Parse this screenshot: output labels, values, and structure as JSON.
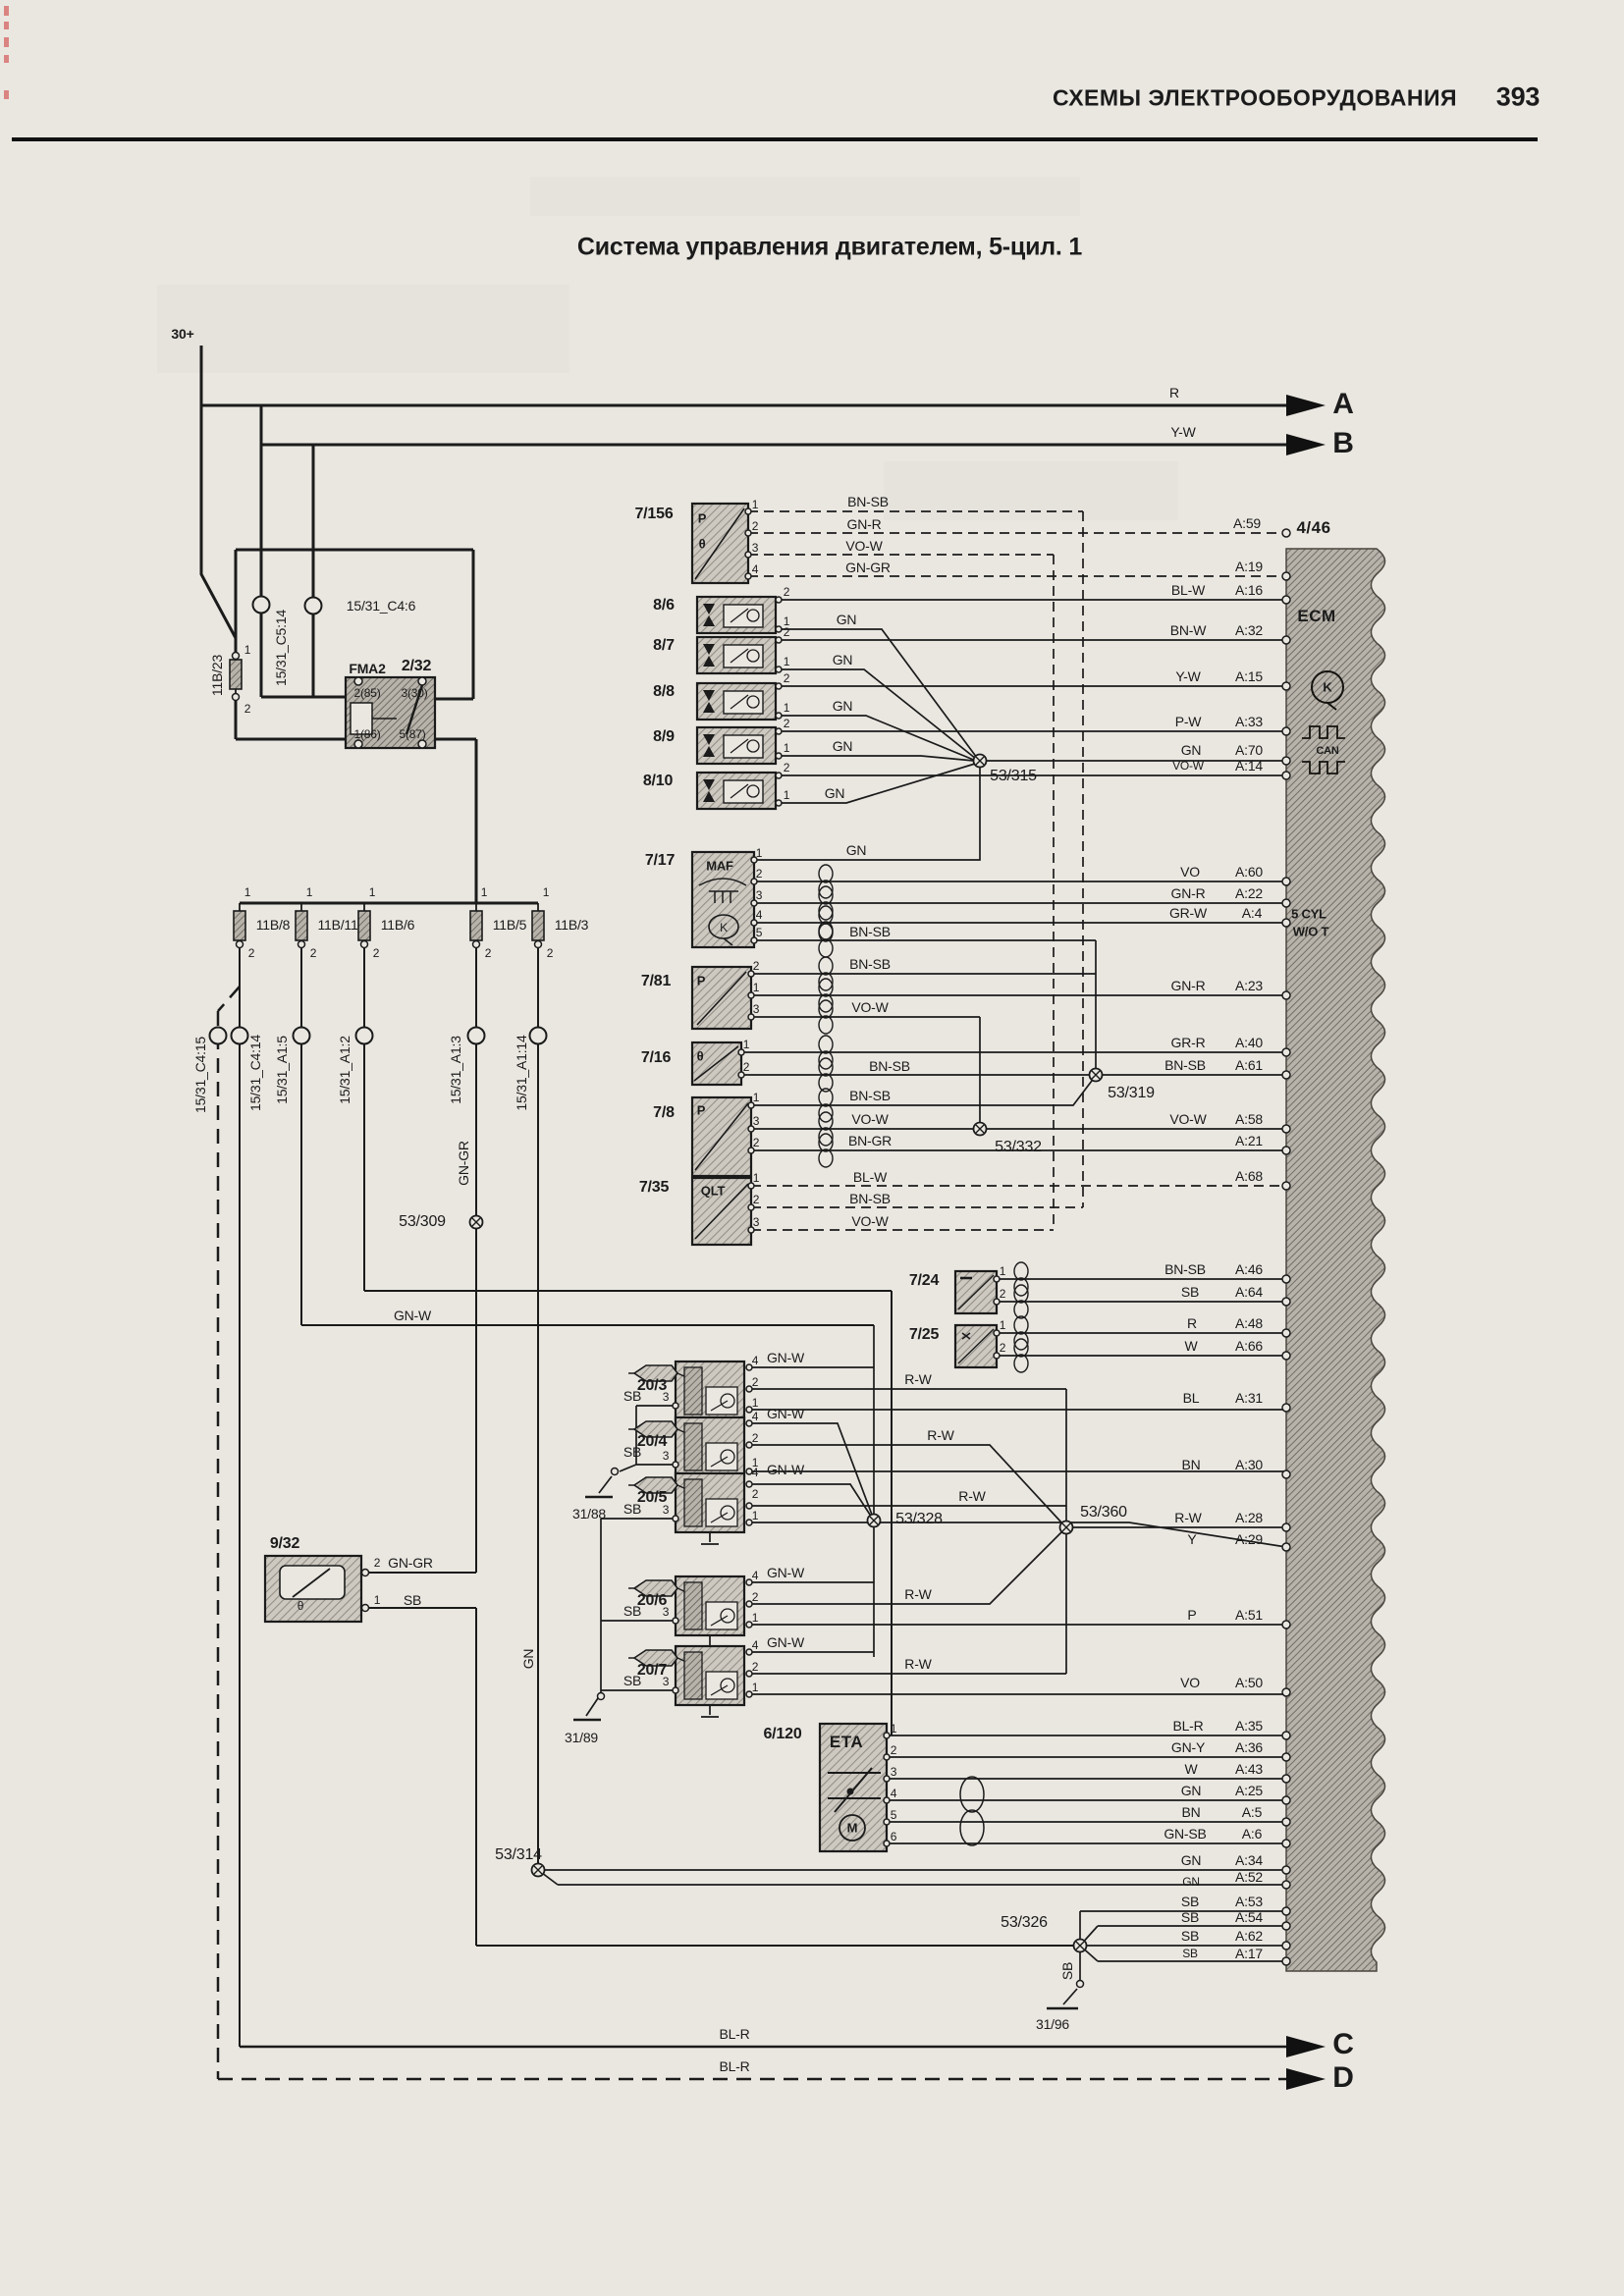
{
  "page": {
    "header": "СХЕМЫ ЭЛЕКТРООБОРУДОВАНИЯ",
    "page_number": "393",
    "title": "Система управления двигателем, 5-цил. 1"
  },
  "net": {
    "plus30": "30+",
    "a": "A",
    "b": "B",
    "c": "C",
    "d": "D"
  },
  "wire_colors": {
    "gn": "GN",
    "gnr": "GN-R",
    "gngr": "GN-GR",
    "gnw": "GN-W",
    "gny": "GN-Y",
    "gnsb": "GN-SB",
    "bn": "BN",
    "bnsb": "BN-SB",
    "bnw": "BN-W",
    "bngr": "BN-GR",
    "bl": "BL",
    "blw": "BL-W",
    "blr": "BL-R",
    "vo": "VO",
    "vow": "VO-W",
    "y": "Y",
    "yw": "Y-W",
    "p": "P",
    "pw": "P-W",
    "r": "R",
    "rw": "R-W",
    "w": "W",
    "sb": "SB",
    "grw": "GR-W",
    "grr": "GR-R"
  },
  "fuses": {
    "f23": "11B/23",
    "f8": "11B/8",
    "f11": "11B/11",
    "f6": "11B/6",
    "f5": "11B/5",
    "f3": "11B/3"
  },
  "connectors": {
    "c514": "15/31_C5:14",
    "c46": "15/31_C4:6",
    "c415": "15/31_C4:15",
    "c414": "15/31_C4:14",
    "a15": "15/31_A1:5",
    "a12": "15/31_A1:2",
    "a13": "15/31_A1:3",
    "a114": "15/31_A1:14"
  },
  "junctions": {
    "j315": "53/315",
    "j319": "53/319",
    "j332": "53/332",
    "j309": "53/309",
    "j328": "53/328",
    "j360": "53/360",
    "j314": "53/314",
    "j326": "53/326"
  },
  "grounds": {
    "g88": "31/88",
    "g89": "31/89",
    "g96": "31/96"
  },
  "components": {
    "relay": {
      "name": "FMA2",
      "id": "2/32",
      "pin85": "2(85)",
      "pin30": "3(30)",
      "pin86": "1(86)",
      "pin87": "5(87)"
    },
    "s7156": {
      "id": "7/156",
      "p": "P",
      "t": "θ"
    },
    "coil1": {
      "id": "8/6"
    },
    "coil2": {
      "id": "8/7"
    },
    "coil3": {
      "id": "8/8"
    },
    "coil4": {
      "id": "8/9"
    },
    "coil5": {
      "id": "8/10"
    },
    "maf": {
      "id": "7/17",
      "label": "MAF",
      "k": "K"
    },
    "s781": {
      "id": "7/81",
      "p": "P"
    },
    "s716": {
      "id": "7/16",
      "t": "θ"
    },
    "s78": {
      "id": "7/8",
      "p": "P"
    },
    "qlt": {
      "id": "7/35",
      "label": "QLT"
    },
    "s724": {
      "id": "7/24"
    },
    "s725": {
      "id": "7/25"
    },
    "inj1": {
      "id": "20/3"
    },
    "inj2": {
      "id": "20/4"
    },
    "inj3": {
      "id": "20/5"
    },
    "inj4": {
      "id": "20/6"
    },
    "inj5": {
      "id": "20/7"
    },
    "eta": {
      "id": "6/120",
      "label": "ETA",
      "m": "M"
    },
    "s932": {
      "id": "9/32",
      "t": "θ"
    }
  },
  "ecm": {
    "label": "ECM",
    "connector": "4/46",
    "k": "K",
    "can": "CAN",
    "cyl_line1": "5 CYL",
    "cyl_line2": "W/O T",
    "pins": {
      "a59": "A:59",
      "a19": "A:19",
      "a16": "A:16",
      "a32": "A:32",
      "a15": "A:15",
      "a33": "A:33",
      "a70": "A:70",
      "a14": "A:14",
      "a60": "A:60",
      "a22": "A:22",
      "a4": "A:4",
      "a23": "A:23",
      "a40": "A:40",
      "a61": "A:61",
      "a58": "A:58",
      "a21": "A:21",
      "a68": "A:68",
      "a46": "A:46",
      "a64": "A:64",
      "a48": "A:48",
      "a66": "A:66",
      "a31": "A:31",
      "a30": "A:30",
      "a28": "A:28",
      "a29": "A:29",
      "a51": "A:51",
      "a50": "A:50",
      "a35": "A:35",
      "a36": "A:36",
      "a43": "A:43",
      "a25": "A:25",
      "a5": "A:5",
      "a6": "A:6",
      "a34": "A:34",
      "a52": "A:52",
      "a53": "A:53",
      "a54": "A:54",
      "a62": "A:62",
      "a17": "A:17"
    }
  },
  "pn": {
    "n1": "1",
    "n2": "2",
    "n3": "3",
    "n4": "4",
    "n5": "5",
    "n6": "6"
  }
}
